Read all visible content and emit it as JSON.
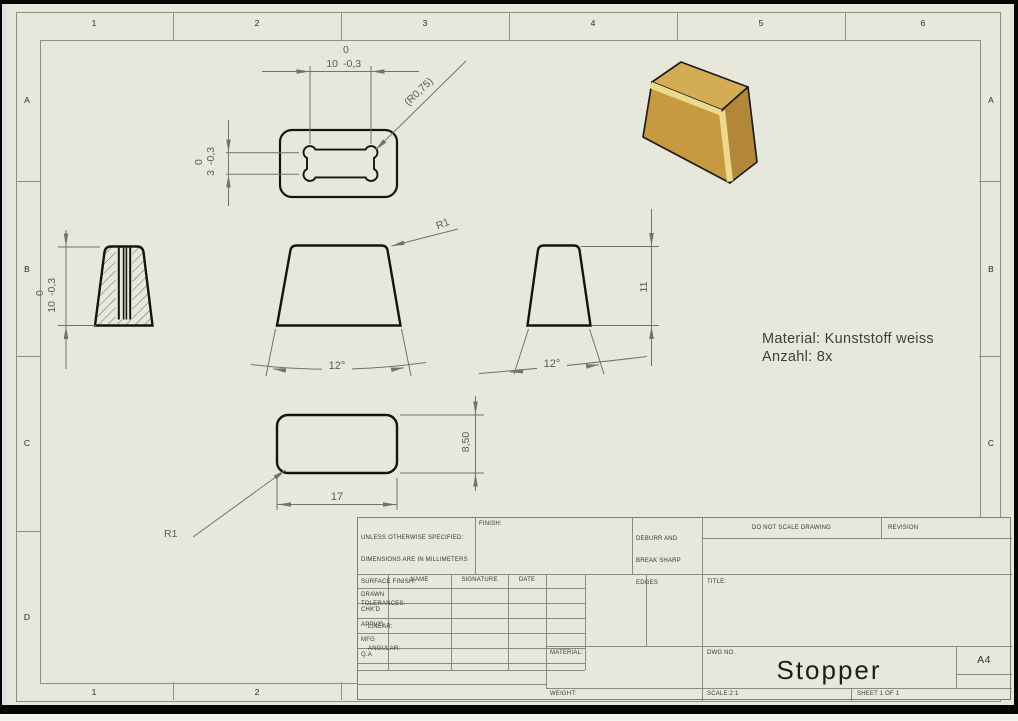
{
  "sheet": {
    "zones": {
      "columns": [
        "1",
        "2",
        "3",
        "4",
        "5",
        "6"
      ],
      "rows": [
        "A",
        "B",
        "C",
        "D"
      ]
    }
  },
  "iso_colors": {
    "front": "#c79a41",
    "top": "#d4ac55",
    "side": "#b2873a",
    "highlight": "#ecd98e"
  },
  "dims": {
    "top_width": {
      "value": "10",
      "upper": "0",
      "lower": "-0,3"
    },
    "top_slot_height": {
      "value": "3",
      "upper": "0",
      "lower": "-0,3"
    },
    "section_height": {
      "value": "10",
      "upper": "0",
      "lower": "-0,3"
    },
    "slot_radius": "(R0,75)",
    "front_corner_radius": "R1",
    "bottom_corner_radius": "R1",
    "front_angle": "12°",
    "side_angle": "12°",
    "side_height": "11",
    "bottom_width": "17",
    "bottom_depth": "8,50"
  },
  "notes": {
    "material": "Material: Kunststoff weiss",
    "quantity": "Anzahl: 8x"
  },
  "title_block": {
    "spec_lines": [
      "UNLESS OTHERWISE SPECIFIED:",
      "DIMENSIONS ARE IN MILLIMETERS",
      "SURFACE FINISH:",
      "TOLERANCES:",
      "LINEAR:",
      "ANGULAR:"
    ],
    "finish_label": "FINISH:",
    "deburr_lines": [
      "DEBURR AND",
      "BREAK SHARP",
      "EDGES"
    ],
    "do_not_scale": "DO NOT SCALE DRAWING",
    "revision_label": "REVISION",
    "columns": {
      "name": "NAME",
      "signature": "SIGNATURE",
      "date": "DATE"
    },
    "rows": [
      "DRAWN",
      "CHK'D",
      "APPV'D",
      "MFG",
      "Q.A"
    ],
    "title_label": "TITLE:",
    "material_label": "MATERIAL:",
    "weight_label": "WEIGHT:",
    "dwg_label": "DWG NO.",
    "drawing_title": "Stopper",
    "paper_size": "A4",
    "scale_label": "SCALE:2:1",
    "sheet_label": "SHEET 1 OF 1"
  }
}
